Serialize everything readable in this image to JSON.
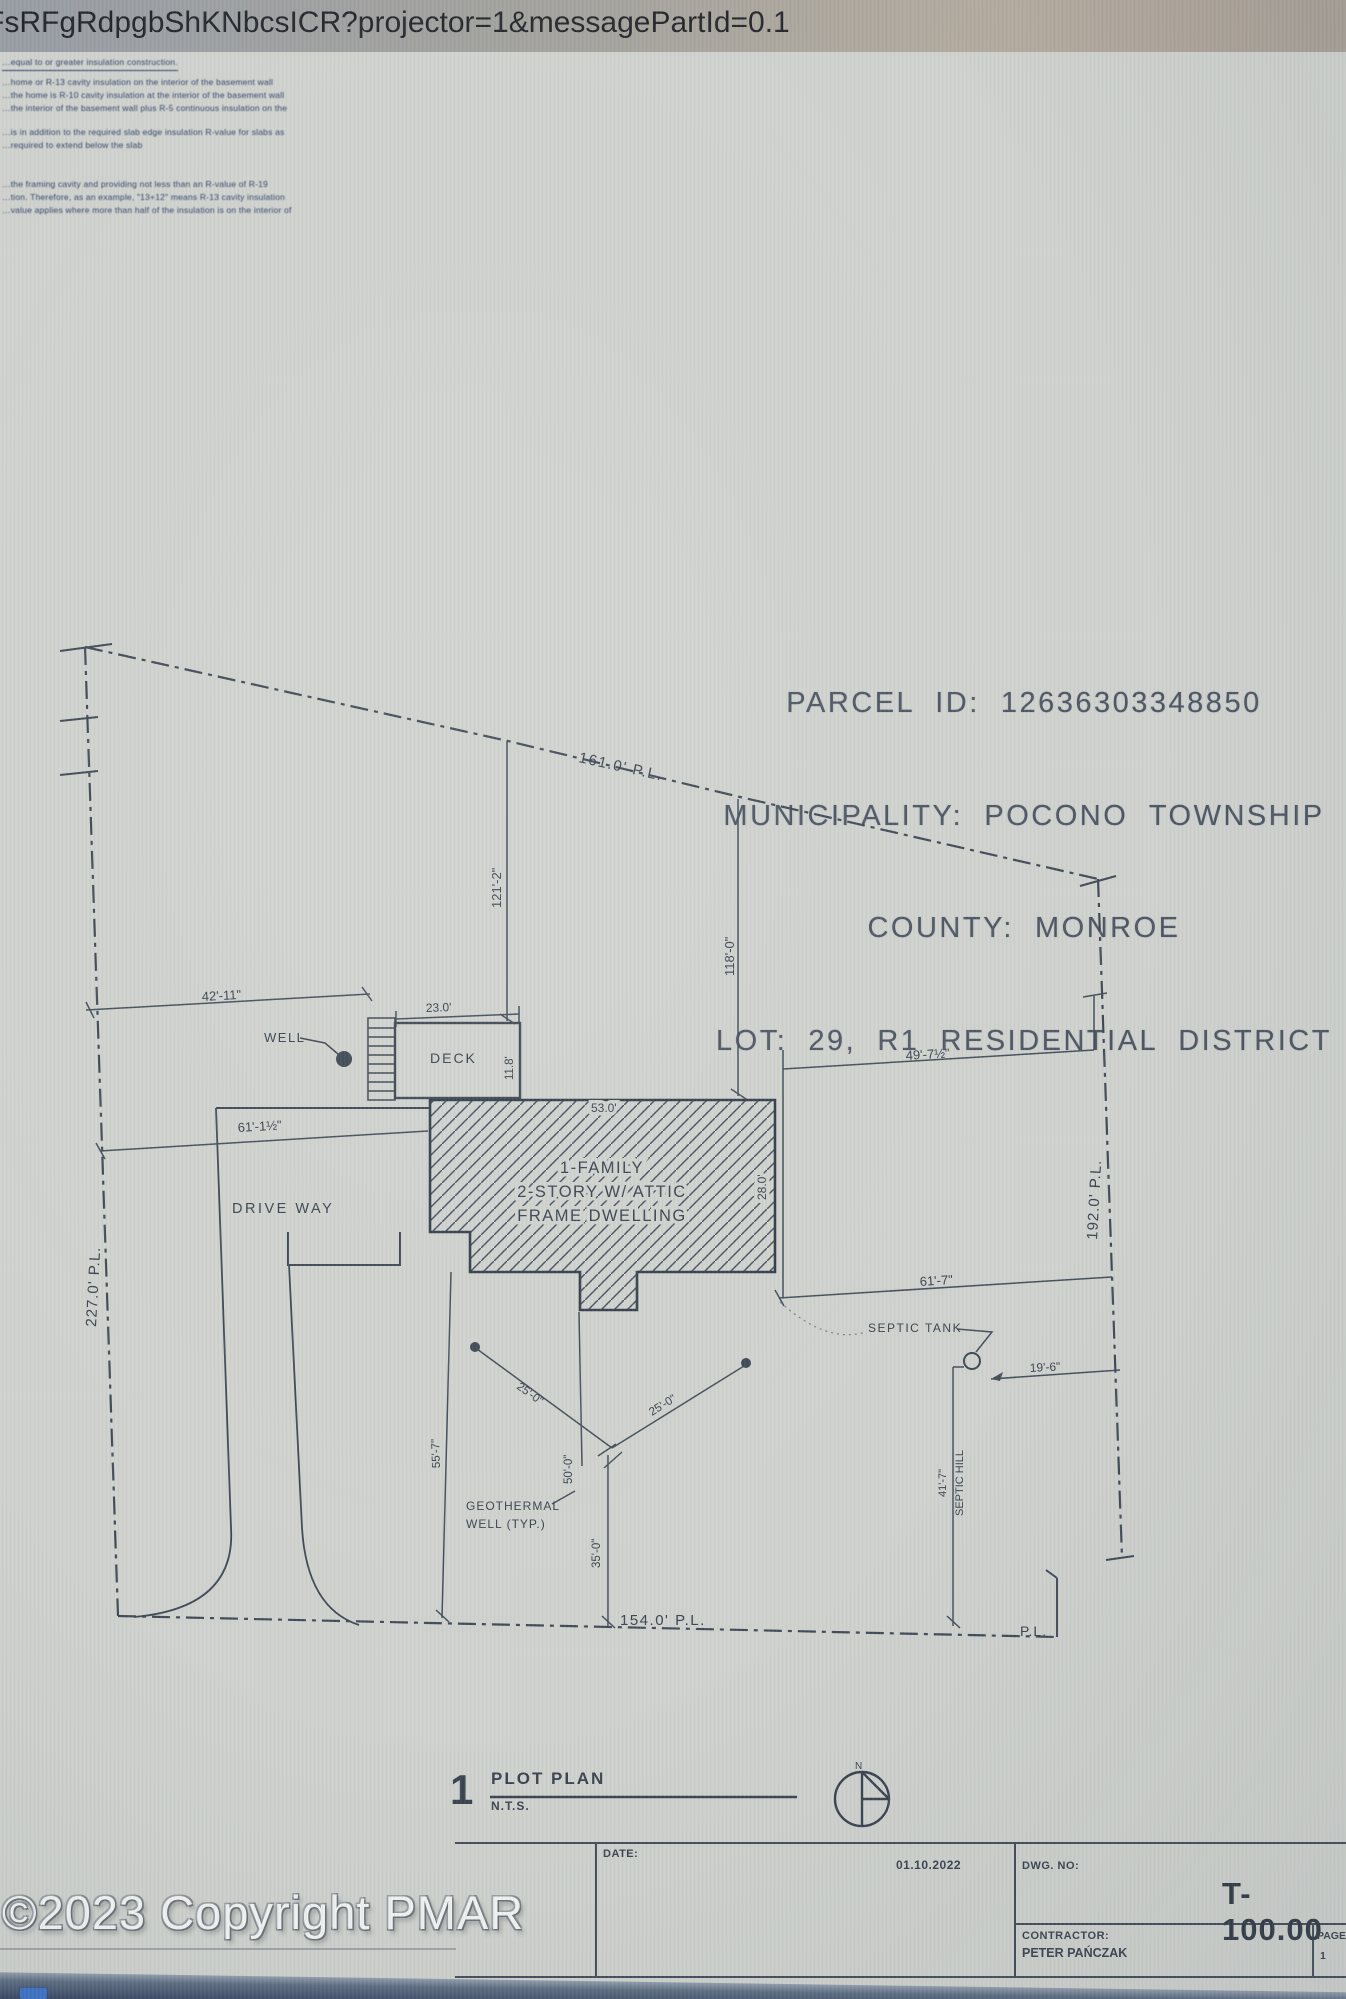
{
  "browser": {
    "url": "FsRFgRdpgbShKNbcsICR?projector=1&messagePartId=0.1"
  },
  "notes": {
    "lines": [
      "…equal to or greater insulation construction.",
      "…home or R-13 cavity insulation on the interior of the basement wall",
      "…the home is R-10 cavity insulation at the interior of the basement wall",
      "…the interior of the basement wall plus R-5 continuous insulation on the",
      "…is in addition to the required slab edge insulation R-value for slabs as",
      "…required to extend below the slab",
      "…the framing cavity and providing not less than an R-value of R-19",
      "…tion. Therefore, as an example, \"13+12\" means R-13 cavity insulation",
      "…value applies where more than half of the insulation is on the interior of"
    ]
  },
  "parcel": {
    "lines": [
      "PARCEL  ID:  12636303348850",
      "MUNICIPALITY:  POCONO  TOWNSHIP",
      "COUNTY:  MONROE",
      "LOT:  29,  R1  RESIDENTIAL  DISTRICT"
    ]
  },
  "plan": {
    "labels": {
      "pl_161": "161.0' P.L.",
      "dim_42_11": "42'-11\"",
      "well": "WELL",
      "dim_23_0": "23.0'",
      "deck": "DECK",
      "dim_11_8": "11.8'",
      "dim_121_2": "121'-2\"",
      "dim_118_0": "118'-0\"",
      "dim_53_0": "53.0'",
      "dwelling_line1": "1-FAMILY",
      "dwelling_line2": "2-STORY W/ ATTIC",
      "dwelling_line3": "FRAME DWELLING",
      "dim_28_0": "28.0'",
      "dim_61_1": "61'-1½\"",
      "driveway": "DRIVE WAY",
      "pl_227": "227.0' P.L.",
      "dim_49_7": "49'-7½\"",
      "pl_192": "192.0' P.L.",
      "dim_61_7": "61'-7\"",
      "septic_tank": "SEPTIC TANK",
      "dim_19_6": "19'-6\"",
      "dim_41_7": "41'-7\"",
      "septic_hill": "SEPTIC HILL",
      "dim_55_7": "55'-7\"",
      "dim_25_0_a": "25'-0\"",
      "dim_25_0_b": "25'-0\"",
      "dim_50_0": "50'-0\"",
      "dim_35_0": "35'-0\"",
      "geothermal_line1": "GEOTHERMAL",
      "geothermal_line2": "WELL (TYP.)",
      "pl_154": "154.0' P.L.",
      "pl_corner": "P.L.",
      "north": "N"
    }
  },
  "plot_title": {
    "number": "1",
    "title": "PLOT PLAN",
    "scale": "N.T.S."
  },
  "titleblock": {
    "date_label": "DATE:",
    "date_value": "01.10.2022",
    "dwg_label": "DWG. NO:",
    "dwg_value": "T-100.00",
    "contractor_label": "CONTRACTOR:",
    "contractor_name": "PETER PAŃCZAK",
    "page_label": "PAGE",
    "page_value": "1"
  },
  "watermark": "©2023 Copyright PMAR",
  "colors": {
    "ink": "#3e4853",
    "paper": "#cfd2cd",
    "band": "#2f3e56",
    "watermark": "#f3f5f3"
  }
}
